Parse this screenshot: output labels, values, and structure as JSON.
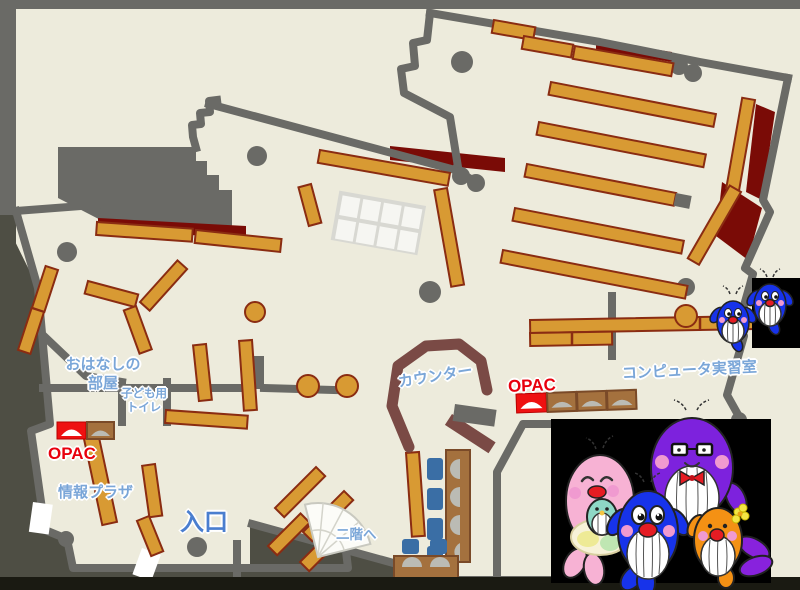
{
  "labels": {
    "storytelling_room": "おはなしの\n部屋",
    "kids_toilet": "子ども用\nトイレ",
    "opac_left": "OPAC",
    "info_plaza": "情報プラザ",
    "entrance": "入口",
    "to_second_floor": "二階へ",
    "counter": "カウンター",
    "opac_right": "OPAC",
    "computer_room": "コンピュータ実習室"
  },
  "colors": {
    "floor": "#EDEBDC",
    "outside": "#4E4E44",
    "bottom_strip": "#1A1A12",
    "wall": "#6A6A66",
    "shelf": "#D89A33",
    "shelf_border": "#8A2C12",
    "dark_red": "#7A0B06",
    "counter": "#7A4A45",
    "desk": "#A4713E",
    "chair": "#3A6EA5",
    "monitor": "#BBBBB4",
    "photo_bg": "#000000",
    "label_blue": "#7AA6D8",
    "entrance_blue": "#4A7ECF",
    "label_red": "#E8000D",
    "mascot_pink": "#F7B2D4",
    "mascot_purple": "#7D22DD",
    "mascot_blue": "#1733EA",
    "mascot_orange": "#F49114",
    "mascot_teal": "#8ED8C6"
  },
  "mascots": {
    "photo_characters": [
      "pink-parent-whale-with-baby",
      "blue-child-whale",
      "purple-parent-whale",
      "orange-child-whale"
    ],
    "map_characters": [
      "small-blue-whale",
      "small-blue-whale"
    ]
  }
}
